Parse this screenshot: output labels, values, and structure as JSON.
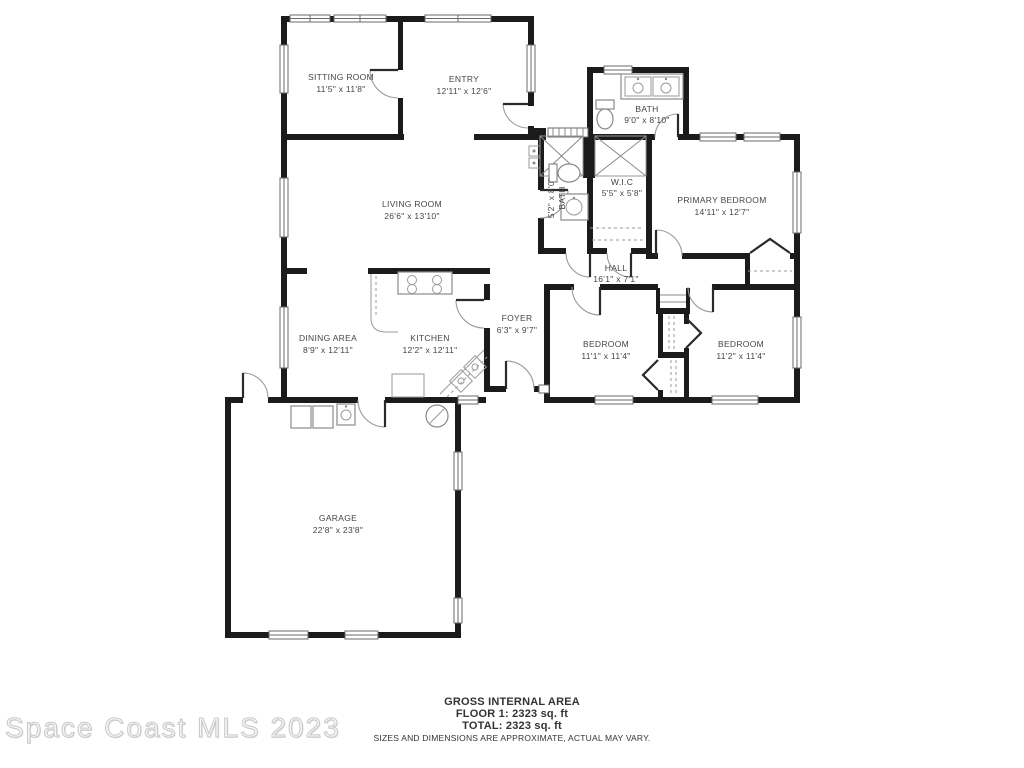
{
  "watermark": "Space Coast MLS 2023",
  "footer": {
    "title": "GROSS INTERNAL AREA",
    "floor1": "FLOOR 1: 2323 sq. ft",
    "total": "TOTAL: 2323 sq. ft",
    "disclaimer": "SIZES AND DIMENSIONS ARE APPROXIMATE, ACTUAL MAY VARY."
  },
  "rooms": [
    {
      "id": "sitting-room",
      "name": "SITTING ROOM",
      "dims": "11'5\" x 11'8\""
    },
    {
      "id": "entry",
      "name": "ENTRY",
      "dims": "12'11\" x 12'6\""
    },
    {
      "id": "bath",
      "name": "BATH",
      "dims": "9'0\" x 8'10\""
    },
    {
      "id": "wic",
      "name": "W.I.C",
      "dims": "5'5\" x 5'8\""
    },
    {
      "id": "primary-bedroom",
      "name": "PRIMARY BEDROOM",
      "dims": "14'11\" x 12'7\""
    },
    {
      "id": "living-room",
      "name": "LIVING ROOM",
      "dims": "26'6\" x 13'10\""
    },
    {
      "id": "bath-2",
      "name": "BATH",
      "dims": "5'2\" x 8'0\""
    },
    {
      "id": "hall",
      "name": "HALL",
      "dims": "16'1\" x 7'1\""
    },
    {
      "id": "dining-area",
      "name": "DINING AREA",
      "dims": "8'9\" x 12'11\""
    },
    {
      "id": "kitchen",
      "name": "KITCHEN",
      "dims": "12'2\" x 12'11\""
    },
    {
      "id": "foyer",
      "name": "FOYER",
      "dims": "6'3\" x 9'7\""
    },
    {
      "id": "bedroom-1",
      "name": "BEDROOM",
      "dims": "11'1\" x 11'4\""
    },
    {
      "id": "bedroom-2",
      "name": "BEDROOM",
      "dims": "11'2\" x 11'4\""
    },
    {
      "id": "garage",
      "name": "GARAGE",
      "dims": "22'8\" x 23'8\""
    }
  ]
}
